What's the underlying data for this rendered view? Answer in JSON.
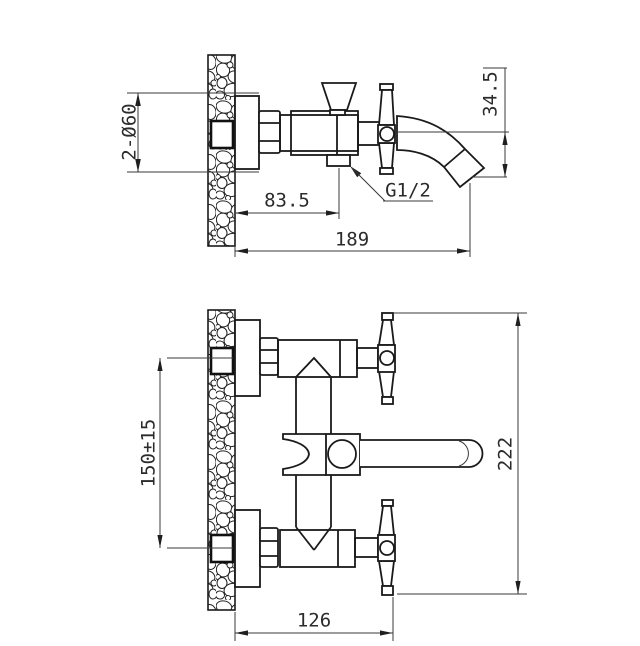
{
  "drawing": {
    "side_view": {
      "flange_diameter": "2-Ø60",
      "wall_to_outlet": "83.5",
      "total_reach": "189",
      "outlet_thread": "G1/2",
      "spout_drop": "34.5"
    },
    "front_view": {
      "inlet_center_distance": "150±15",
      "total_height": "222",
      "body_width": "126"
    }
  }
}
